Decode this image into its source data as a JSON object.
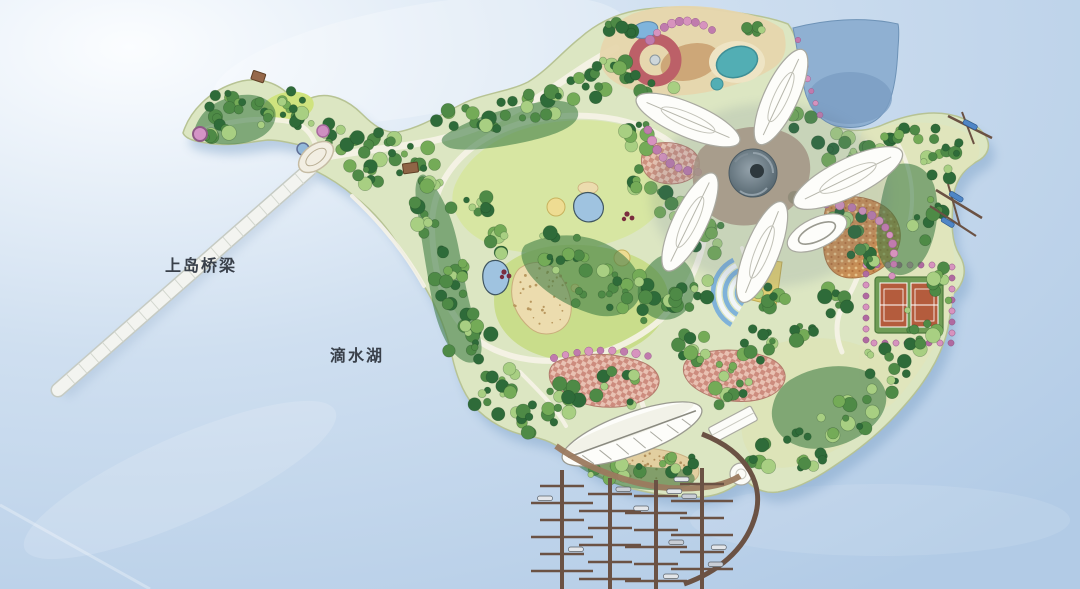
{
  "figure": {
    "kind": "island-park-site-plan"
  },
  "labels": {
    "bridge": "上岛桥梁",
    "lake": "滴水湖"
  },
  "colors": {
    "water_light": "#fbfdff",
    "water_mid": "#cfdff0",
    "water_deep": "#b2cbe6",
    "island": "#dce6c2",
    "island_pale": "#e0e4bb",
    "lawn": "#c9dd8b",
    "lawn_light": "#d7e6a2",
    "sand": "#ecdcae",
    "beach": "#e2cfa0",
    "tree_dark": "#2e6b39",
    "tree_mid": "#4e8a46",
    "tree_light": "#74ab57",
    "tree_pale": "#a8cf82",
    "path": "#f6f3e8",
    "pier": "#6b5244",
    "petal": "#fdfdfa",
    "flower_core": "#5e7078",
    "lagoon": "#8fb0d2",
    "pond": "#9fc3e0",
    "tennis_green": "#6f9c55",
    "court_orange": "#b45c3d",
    "ring_red": "#bc6068",
    "teal_pool": "#52aeb4",
    "pink": "#d793be",
    "checker": "#cd887b",
    "mosaic": "#c98f55",
    "plaza_yellow": "#e3cf6f",
    "stripe_blue": "#7fb2d9",
    "bridge": "#f3f4f0",
    "label": "#39404a",
    "boat_blue": "#4f86c6"
  },
  "features": [
    "dishui-lake-water",
    "water-highlight",
    "access-bridge",
    "bridge-deck-tick",
    "island",
    "island-shadow",
    "peninsula",
    "entry-plaza",
    "teardrop-pond",
    "garden-circle-pink",
    "peninsula-pavilion",
    "upper-lawn",
    "lower-lawn",
    "sand-garden",
    "lawn-pond",
    "yellow-feature-circle",
    "tree-mass",
    "tree",
    "loop-path",
    "promenade-path",
    "flower-pavilion",
    "petal-roof",
    "detached-petal-roof",
    "spiral-core",
    "core-plaza",
    "children-playground",
    "red-ring-feature",
    "teal-pool",
    "blue-pond",
    "pink-tree-spiral",
    "lagoon-bay",
    "mosaic-terrace",
    "yellow-plaza",
    "terraced-amphitheater",
    "checker-plaza",
    "tennis-courts",
    "tennis-court",
    "flowering-tree",
    "leaf-pavilion",
    "service-building",
    "dome-pavilion",
    "beach",
    "beach-hedge",
    "marina",
    "marina-pier",
    "finger-dock",
    "boat",
    "arc-pier",
    "promenade-edge",
    "boat-jetty",
    "moored-boat-blue",
    "bridge-label",
    "lake-label"
  ]
}
